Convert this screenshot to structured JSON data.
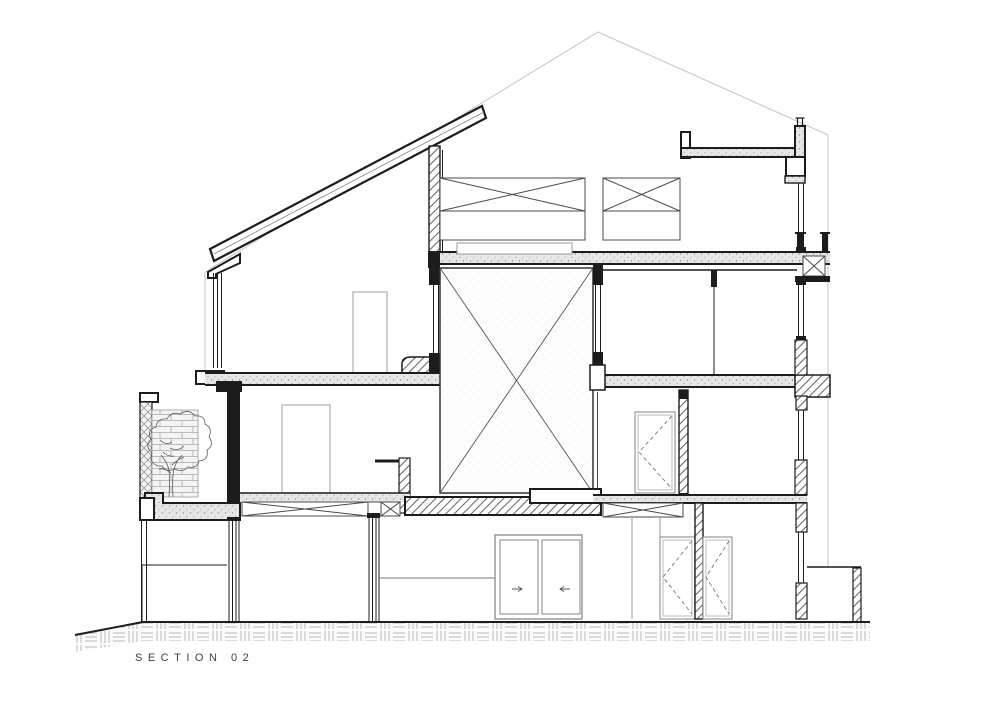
{
  "drawing": {
    "label": "SECTION 02"
  },
  "colors": {
    "line": "#1c1c1c",
    "secondary_line": "#777777",
    "background_line": "#c4c4c4",
    "frame_gray": "#adadad",
    "concrete_fill": "#e7e7e7",
    "hatch_line": "#666666",
    "brick_line": "#a8a8a8",
    "ground_hatch_line": "#b9b9b9",
    "paper": "#ffffff",
    "label_text": "#3d3d3d"
  }
}
